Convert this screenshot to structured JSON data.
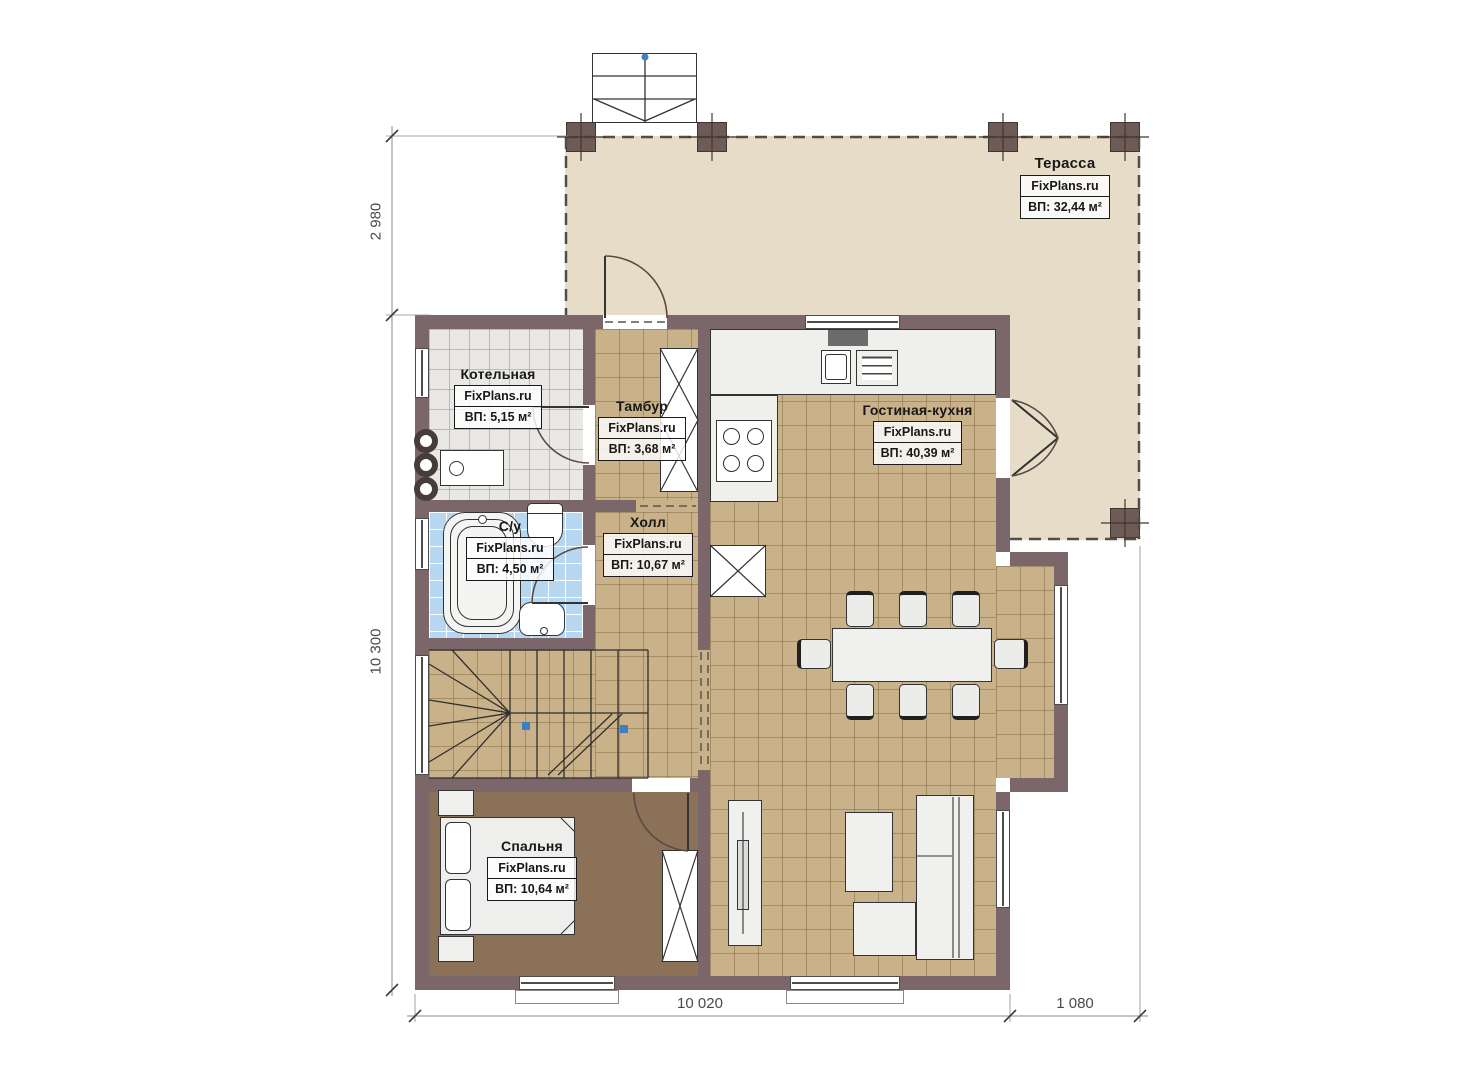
{
  "brand": "FixPlans.ru",
  "rooms": {
    "terrace": {
      "name": "Терасса",
      "area": "ВП: 32,44 м²"
    },
    "boiler": {
      "name": "Котельная",
      "area": "ВП: 5,15 м²"
    },
    "tambour": {
      "name": "Тамбур",
      "area": "ВП: 3,68 м²"
    },
    "living": {
      "name": "Гостиная-кухня",
      "area": "ВП: 40,39 м²"
    },
    "hall": {
      "name": "Холл",
      "area": "ВП: 10,67 м²"
    },
    "bathroom": {
      "name": "С/у",
      "area": "ВП: 4,50 м²"
    },
    "bedroom": {
      "name": "Спальня",
      "area": "ВП: 10,64 м²"
    }
  },
  "dimensions": {
    "terrace_depth": "2 980",
    "house_depth": "10 300",
    "house_width": "10 020",
    "terrace_overhang": "1 080"
  },
  "colors": {
    "wall": "#7b6769",
    "terrace_floor": "#e6dcc7",
    "tile_floor": "#c9b189",
    "bathroom_floor": "#b7d7f1",
    "boiler_floor": "#e9e8e5",
    "bedroom_floor": "#8b7157",
    "furniture_outline": "#333333",
    "stair_marker_blue": "#3f7fc1",
    "dimension_text": "#4a4a4a"
  }
}
